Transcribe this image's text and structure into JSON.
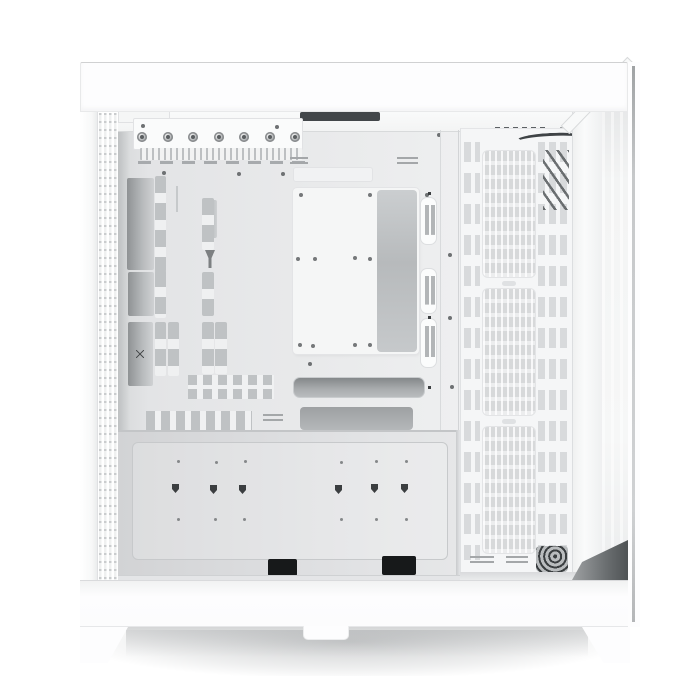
{
  "scene": {
    "description": "Studio product photo of a white dual-chamber mid-tower PC case shown from the open left side: white top panel and base, perforated rear strip, motherboard tray with cable-routing cutouts, motherboard mounting plate with standoff holes, three-slot front fan mesh panel, tempered glass front edge, PSU shroud with keyhole mounts, and two angled white feet over a soft floor shadow.",
    "product_type": "pc-case",
    "view": "left-side interior, side panel removed",
    "visible_text": "none"
  },
  "palette": {
    "bg": "#ffffff",
    "case_white": "#fdfdfe",
    "panel_line": "#e3e5e6",
    "tray_gray": "#ebecee",
    "recess_dark": "#8f9294",
    "slot_gray": "#bfc2c4",
    "mesh_gray": "#ecedee",
    "opening_dark": "#9da0a2",
    "hardware_dark": "#505456",
    "grommet_black": "#17191a",
    "glass_tint": "#f3f4f4"
  },
  "parts": {
    "thumbscrews": 7,
    "fan_mesh_zones": 3,
    "grommet_slot_groups": 3,
    "keyhole_mounts": 6,
    "bottom_grommets": 2,
    "feet_visible": 2,
    "cable_openings": 2
  }
}
